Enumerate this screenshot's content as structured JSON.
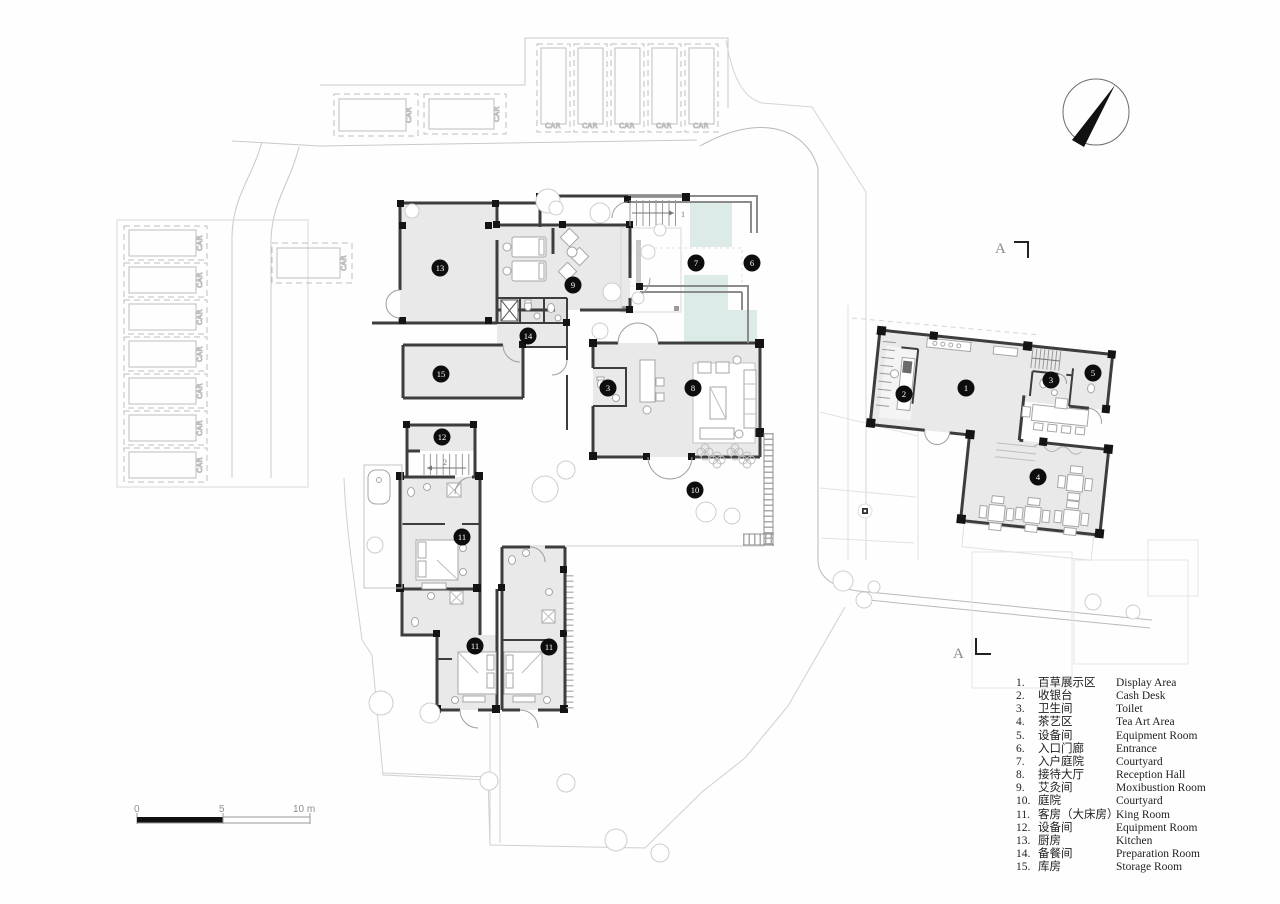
{
  "drawing": {
    "type": "site-floor-plan"
  },
  "colors": {
    "room_fill": "#e9e9e9",
    "wall": "#3d3d3d",
    "column": "#141414",
    "water": "#dcebe8",
    "site_line": "#c9c9c9",
    "furniture_line": "#a6a6a6",
    "marker_bg": "#0d0d0d",
    "marker_text": "#ffffff"
  },
  "parking": {
    "car_label": "CAR"
  },
  "stairs": {
    "upper_label": "1",
    "lower_label": "2"
  },
  "section": {
    "letter": "A"
  },
  "scale_bar": {
    "labels": [
      "0",
      "5",
      "10 m"
    ]
  },
  "markers": [
    {
      "n": "13",
      "x": 440,
      "y": 268
    },
    {
      "n": "9",
      "x": 573,
      "y": 285
    },
    {
      "n": "7",
      "x": 696,
      "y": 263
    },
    {
      "n": "6",
      "x": 752,
      "y": 263
    },
    {
      "n": "14",
      "x": 528,
      "y": 336
    },
    {
      "n": "15",
      "x": 441,
      "y": 374
    },
    {
      "n": "3",
      "x": 608,
      "y": 388
    },
    {
      "n": "8",
      "x": 693,
      "y": 388
    },
    {
      "n": "12",
      "x": 442,
      "y": 437
    },
    {
      "n": "10",
      "x": 695,
      "y": 490
    },
    {
      "n": "11",
      "x": 462,
      "y": 537
    },
    {
      "n": "11",
      "x": 475,
      "y": 646
    },
    {
      "n": "11",
      "x": 549,
      "y": 647
    },
    {
      "n": "1",
      "x": 966,
      "y": 388
    },
    {
      "n": "2",
      "x": 904,
      "y": 394
    },
    {
      "n": "3",
      "x": 1051,
      "y": 380
    },
    {
      "n": "5",
      "x": 1093,
      "y": 373
    },
    {
      "n": "4",
      "x": 1038,
      "y": 477
    }
  ],
  "legend": {
    "rows": [
      {
        "num": "1.",
        "zh": "百草展示区",
        "en": "Display Area"
      },
      {
        "num": "2.",
        "zh": "收银台",
        "en": "Cash Desk"
      },
      {
        "num": "3.",
        "zh": "卫生间",
        "en": "Toilet"
      },
      {
        "num": "4.",
        "zh": "茶艺区",
        "en": "Tea Art Area"
      },
      {
        "num": "5.",
        "zh": "设备间",
        "en": "Equipment Room"
      },
      {
        "num": "6.",
        "zh": "入口门廊",
        "en": "Entrance"
      },
      {
        "num": "7.",
        "zh": "入户庭院",
        "en": "Courtyard"
      },
      {
        "num": "8.",
        "zh": "接待大厅",
        "en": "Reception Hall"
      },
      {
        "num": "9.",
        "zh": "艾灸间",
        "en": "Moxibustion Room"
      },
      {
        "num": "10.",
        "zh": "庭院",
        "en": "Courtyard"
      },
      {
        "num": "11.",
        "zh": "客房（大床房）",
        "en": "King Room"
      },
      {
        "num": "12.",
        "zh": "设备间",
        "en": "Equipment Room"
      },
      {
        "num": "13.",
        "zh": "厨房",
        "en": "Kitchen"
      },
      {
        "num": "14.",
        "zh": "备餐间",
        "en": "Preparation Room"
      },
      {
        "num": "15.",
        "zh": "库房",
        "en": "Storage Room"
      }
    ]
  }
}
